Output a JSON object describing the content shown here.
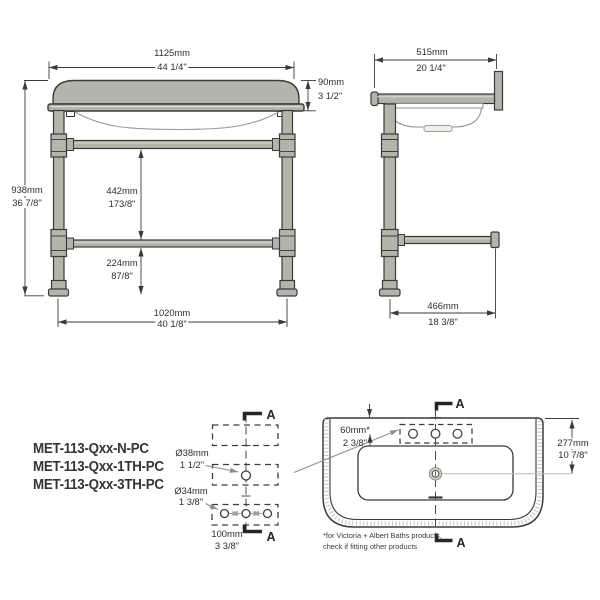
{
  "front": {
    "width_mm": "1125mm",
    "width_in": "44 1/4\"",
    "thickness_mm": "90mm",
    "thickness_in": "3 1/2\"",
    "height_mm": "938mm",
    "height_in": "36 7/8\"",
    "rail_gap_mm": "442mm",
    "rail_gap_in": "173/8\"",
    "lower_rail_mm": "224mm",
    "lower_rail_in": "87/8\"",
    "leg_span_mm": "1020mm",
    "leg_span_in": "40 1/8\""
  },
  "side": {
    "depth_mm": "515mm",
    "depth_in": "20 1/4\"",
    "rail_depth_mm": "466mm",
    "rail_depth_in": "18 3/8\""
  },
  "section": {
    "marker": "A",
    "large_hole_dia": "Ø38mm",
    "large_hole_in": "1 1/2\"",
    "small_hole_dia": "Ø34mm",
    "small_hole_in": "1 3/8\"",
    "spacing_mm": "100mm",
    "spacing_in": "3 3/8\""
  },
  "plan": {
    "marker": "A",
    "tap_setback_mm": "60mm*",
    "tap_setback_in": "2 3/8\"",
    "drain_setback_mm": "277mm",
    "drain_setback_in": "10 7/8\"",
    "footnote_line1": "*for Victoria + Albert Baths products,",
    "footnote_line2": "check if fitting other products"
  },
  "product_codes": [
    "MET-113-Qxx-N-PC",
    "MET-113-Qxx-1TH-PC",
    "MET-113-Qxx-3TH-PC"
  ],
  "colors": {
    "outline": "#3a3a38",
    "metal_fill": "#b4b4ac",
    "light_line": "#9c9c96",
    "text": "#2d2d2b"
  }
}
